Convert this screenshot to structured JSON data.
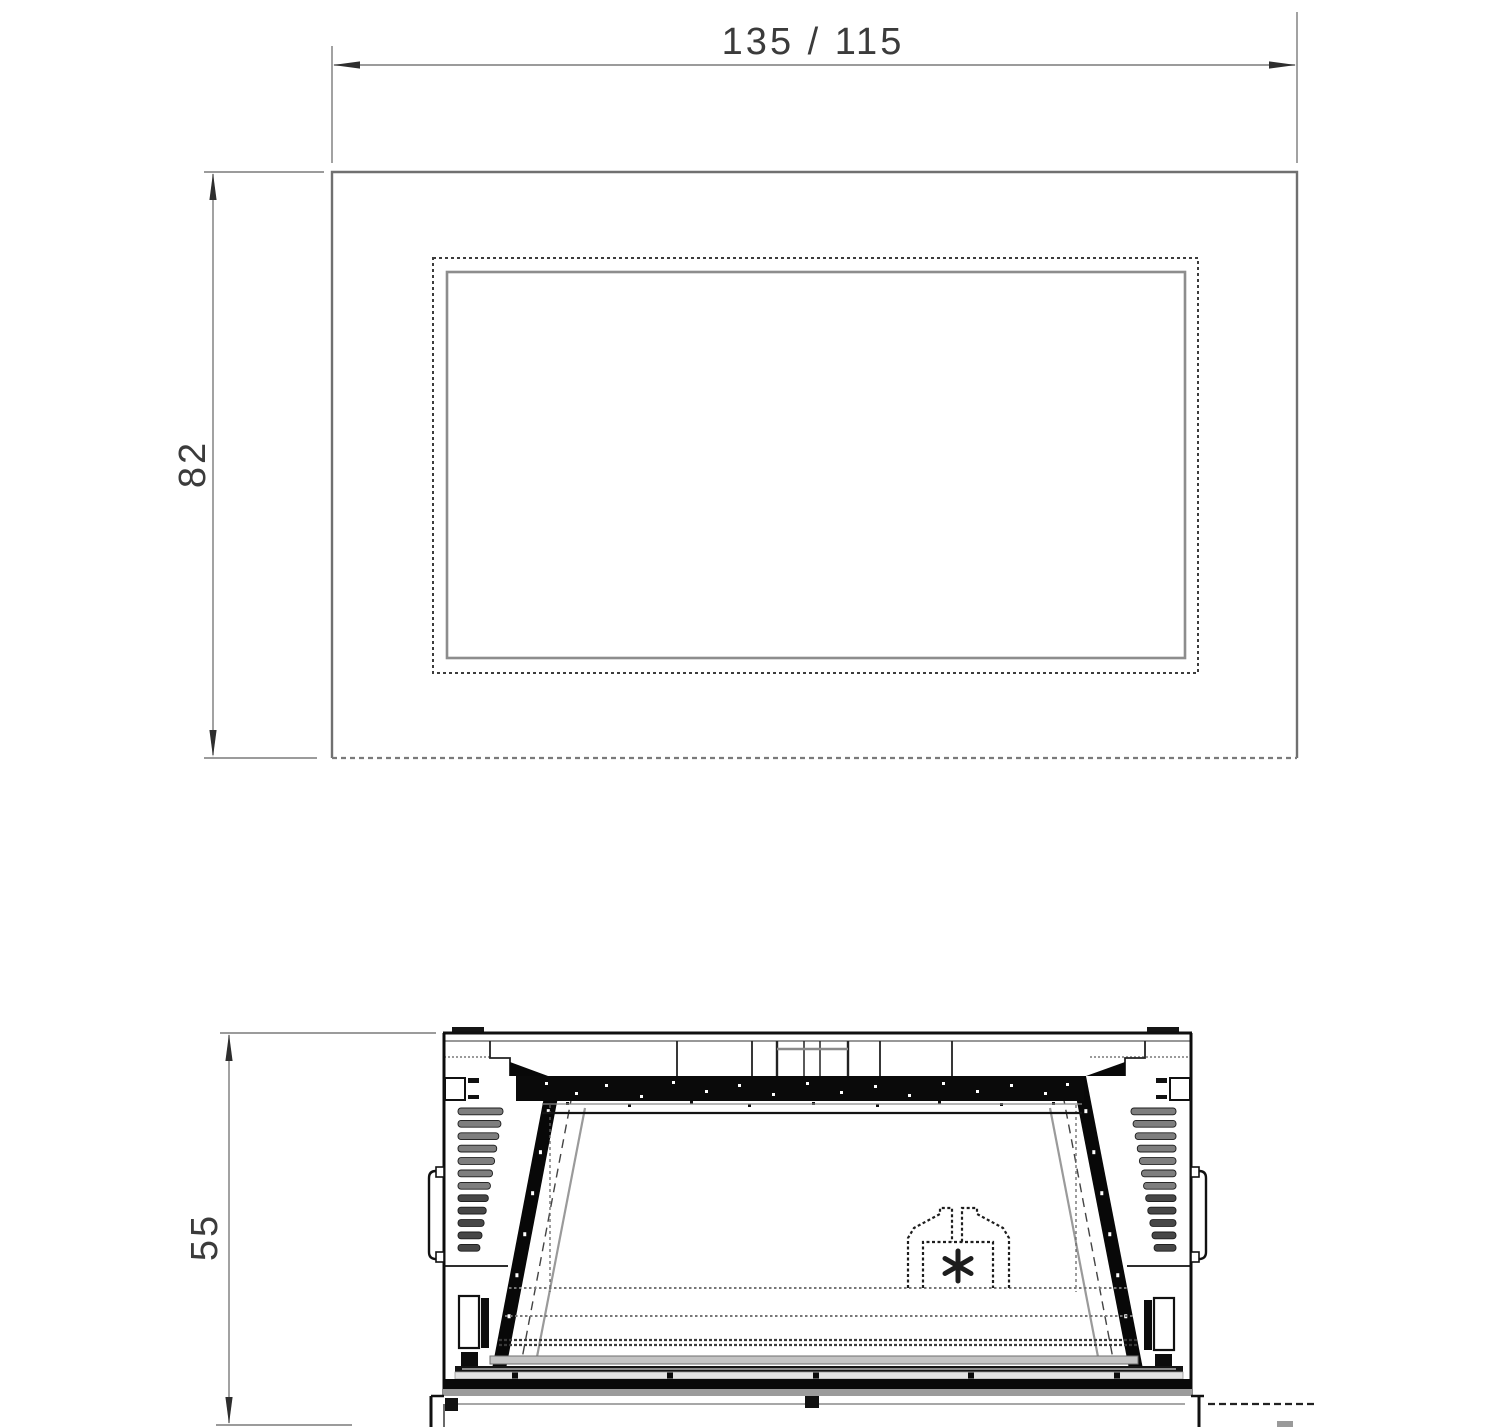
{
  "drawing": {
    "kind": "fireplace-insert-technical-drawing",
    "ink_color": "#161616",
    "dim_color": "#777777",
    "text_color": "#3b3b3b",
    "dimensions": {
      "width_label": "135 / 115",
      "depth_label": "82",
      "height_label": "55"
    }
  }
}
